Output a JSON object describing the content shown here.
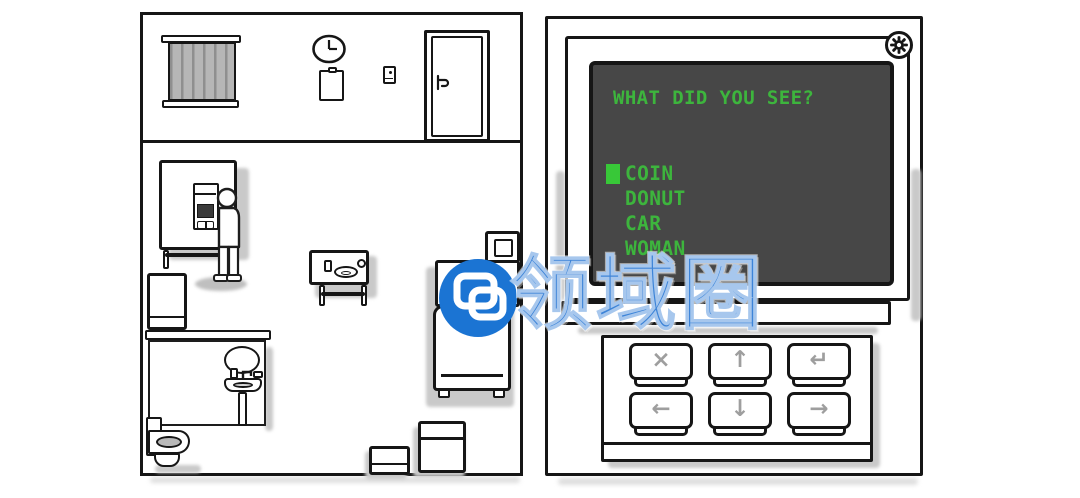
{
  "watermark": {
    "text": "领域圈",
    "text_color": "#3D84D8",
    "logo_bg": "#1B74D3"
  },
  "settings_button": {
    "icon": "gear"
  },
  "terminal": {
    "question": "WHAT DID YOU SEE?",
    "menu": {
      "items": [
        "COIN",
        "DONUT",
        "CAR",
        "WOMAN"
      ],
      "selected_index": 0,
      "selected_item": "COIN"
    },
    "colors": {
      "screen_bg": "#474747",
      "text_green": "#3DB53D",
      "cursor_green": "#38C838"
    }
  },
  "keypad": {
    "keys": [
      {
        "name": "cancel",
        "glyph": "×"
      },
      {
        "name": "up",
        "glyph": "↑"
      },
      {
        "name": "enter",
        "glyph": "↵"
      },
      {
        "name": "left",
        "glyph": "←"
      },
      {
        "name": "down",
        "glyph": "↓"
      },
      {
        "name": "right",
        "glyph": "→"
      }
    ],
    "glyph_color": "#9E9E9E"
  },
  "room": {
    "objects": [
      "window-blinds",
      "wall-clock",
      "clipboard",
      "light-switch",
      "door",
      "desk-panel",
      "memory-machine",
      "standing-person",
      "side-table",
      "cabinet",
      "bathroom-counter",
      "bathroom-mirror",
      "sink",
      "toilet",
      "washing-machine",
      "crate-large",
      "crate-small"
    ]
  }
}
